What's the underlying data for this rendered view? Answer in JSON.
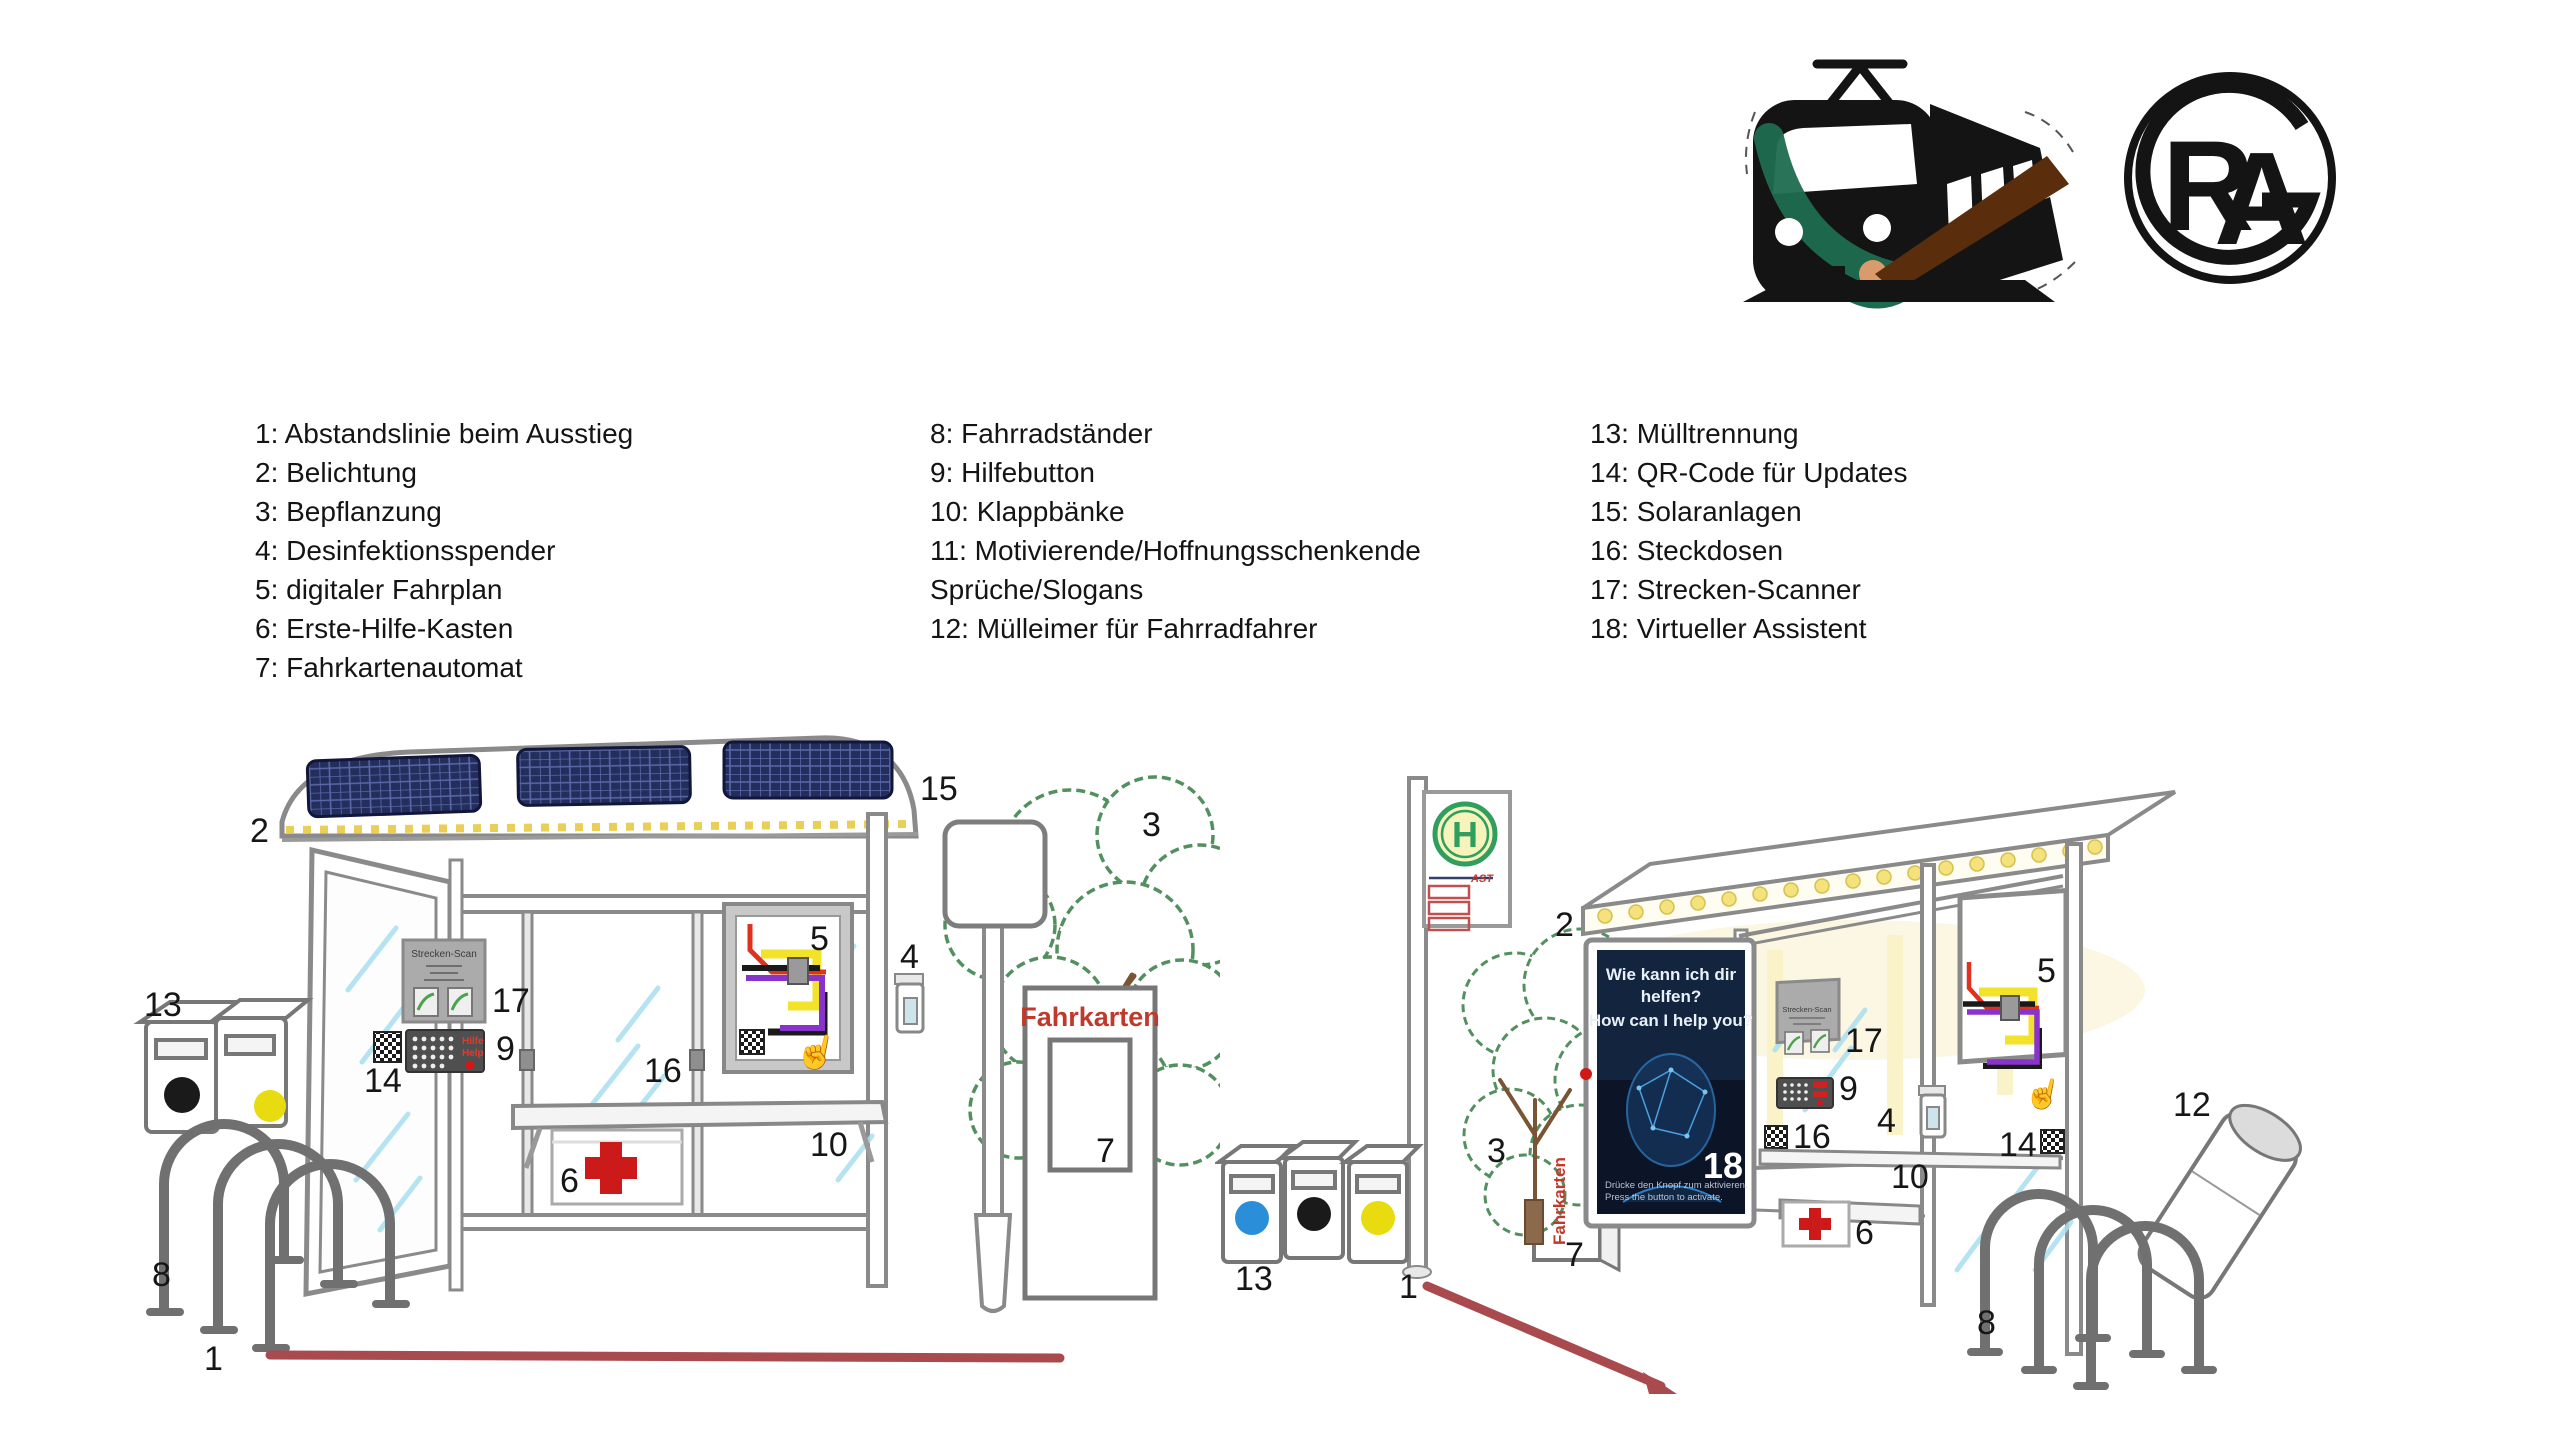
{
  "legend": {
    "col1": [
      "1: Abstandslinie beim Ausstieg",
      "2: Belichtung",
      "3: Bepflanzung",
      "4: Desinfektionsspender",
      "5: digitaler Fahrplan",
      "6: Erste-Hilfe-Kasten",
      "7: Fahrkartenautomat"
    ],
    "col2": [
      "8: Fahrradständer",
      "9: Hilfebutton",
      "10: Klappbänke",
      "11: Motivierende/Hoffnungsschenkende",
      "Sprüche/Slogans",
      "12: Mülleimer für Fahrradfahrer"
    ],
    "col3": [
      "13: Mülltrennung",
      "14: QR-Code für Updates",
      "15: Solaranlagen",
      "16: Steckdosen",
      "17: Strecken-Scanner",
      "18: Virtueller Assistent"
    ]
  },
  "logos": {
    "train": {
      "icon": "train-with-paintbrush-icon"
    },
    "gra": {
      "letter_r": "R",
      "letter_a": "A"
    }
  },
  "scenes": {
    "left": {
      "callouts": [
        "15",
        "2",
        "3",
        "17",
        "9",
        "14",
        "5",
        "16",
        "4",
        "10",
        "6",
        "13",
        "8",
        "1",
        "7"
      ],
      "strecken_scan_label": "Strecken-Scan",
      "keypad": {
        "line1": "Hilfe",
        "line2": "Help"
      },
      "fahrkarten_label": "Fahrkarten",
      "hand_icon": "☝"
    },
    "right": {
      "callouts": [
        "2",
        "3",
        "13",
        "1",
        "7",
        "18",
        "17",
        "9",
        "16",
        "4",
        "5",
        "14",
        "10",
        "6",
        "12",
        "8"
      ],
      "sign_letter": "H",
      "sign_ast": "AST",
      "fahrkarten_label": "Fahrkarten",
      "strecken_scan_label": "Strecken-Scan",
      "hand_icon": "☝",
      "poster": {
        "line1": "Wie kann ich dir",
        "line2": "helfen?",
        "line3": "How can I help you?",
        "footer1": "Drücke den Knopf zum aktivieren.",
        "footer2": "Press the button to activate.",
        "number": "18"
      }
    }
  },
  "colors": {
    "distance_line_red": "#a84a4e",
    "fahrkarten_red": "#c0392b",
    "stop_sign_green": "#2f9e5f",
    "solar_panel_blue": "#232e5c",
    "led_yellow": "#f0dd7e",
    "poster_navy": "#0c1527",
    "route_red": "#e03020",
    "route_yellow": "#f2e22a",
    "route_purple": "#8833cc",
    "foliage_green": "#53905f"
  }
}
